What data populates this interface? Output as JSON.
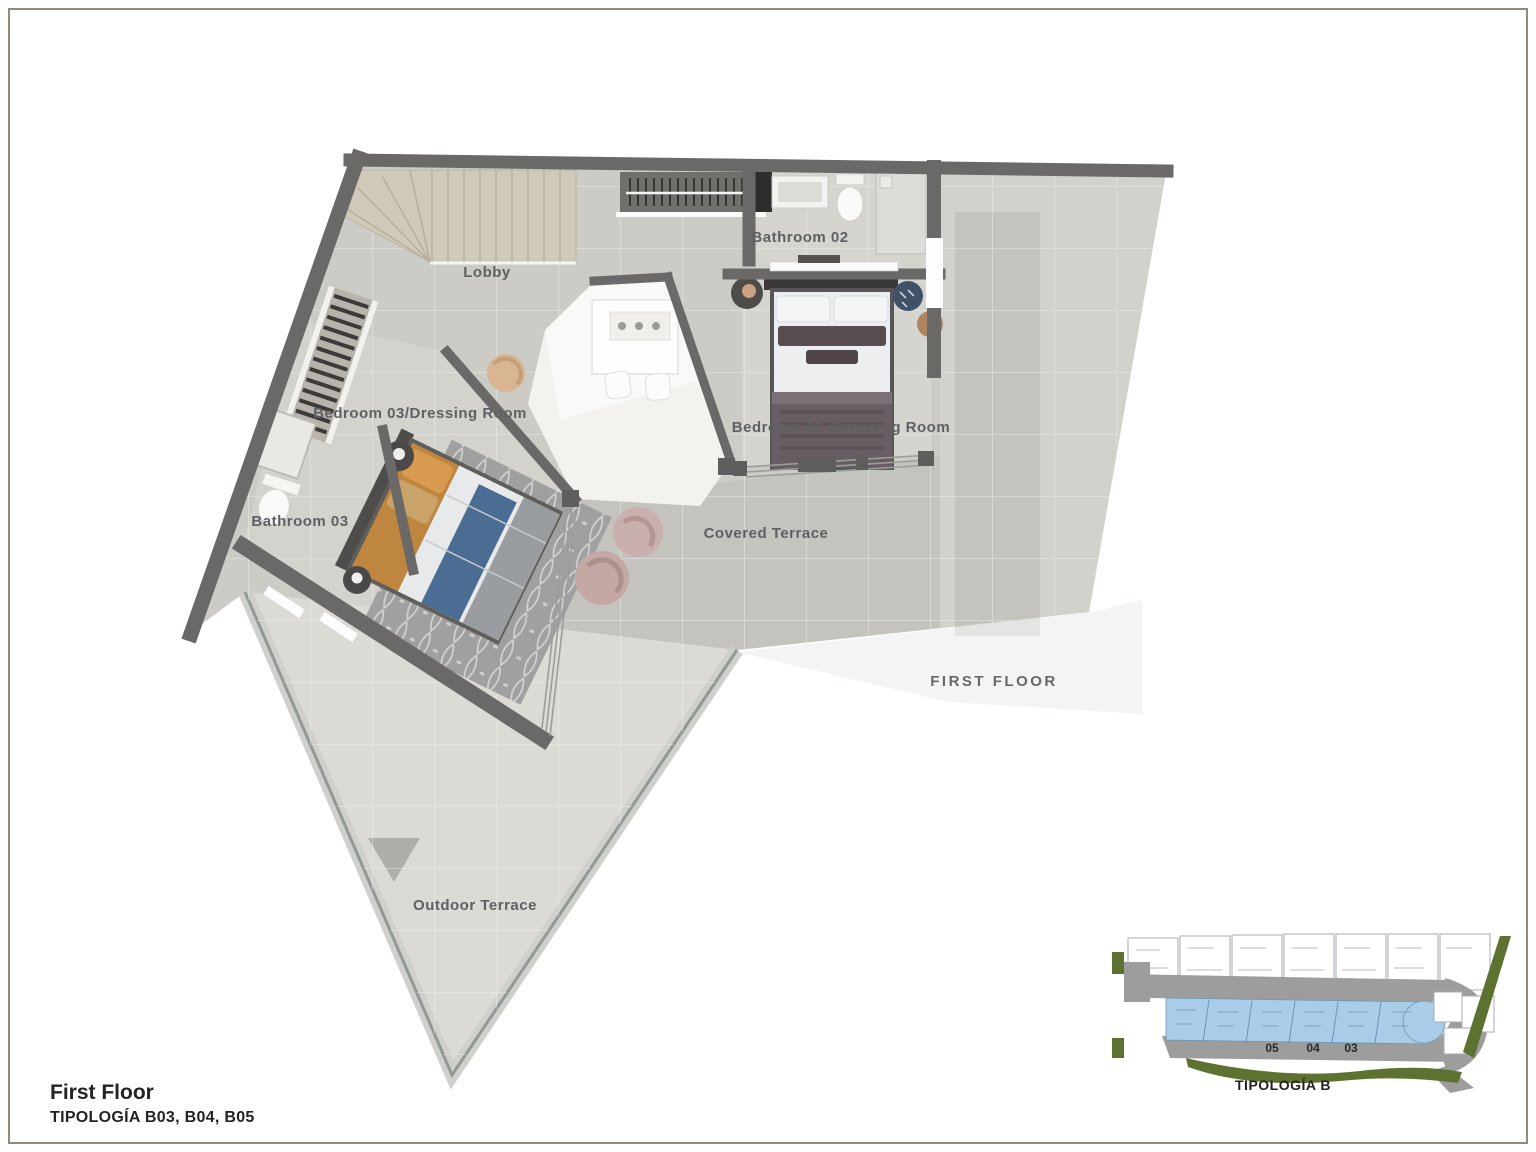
{
  "page": {
    "background": "#ffffff",
    "frame_color": "#8f8e74"
  },
  "plan": {
    "labels": {
      "lobby": "Lobby",
      "bathroom02": "Bathroom 02",
      "bedroom03": "Bedroom 03/Dressing Room",
      "bathroom03": "Bathroom 03",
      "bedroom02": "Bedroom 02 /Dressing Room",
      "covered_terrace": "Covered Terrace",
      "outdoor_terrace": "Outdoor Terrace",
      "floor_tag": "FIRST FLOOR"
    }
  },
  "title_block": {
    "title": "First Floor",
    "subtitle": "TIPOLOGÍA B03, B04, B05"
  },
  "inset": {
    "caption": "TIPOLOGÍA B",
    "unit_numbers": [
      "05",
      "04",
      "03"
    ]
  },
  "colors": {
    "wall": "#6a6967",
    "floor": "#cdcbc6",
    "covered_terrace": "#c5c3be",
    "outdoor_terrace": "#dcdad4",
    "stair_beige": "#cfc9ba",
    "bed_orange": "#bf8640",
    "bed_blue": "#4c6d93",
    "rug_gray": "#a0a0a0",
    "highlight_blue": "#a9cde9",
    "landscape_green": "#5d7130",
    "road_gray": "#9d9d9d",
    "label_gray": "#5f6163"
  }
}
